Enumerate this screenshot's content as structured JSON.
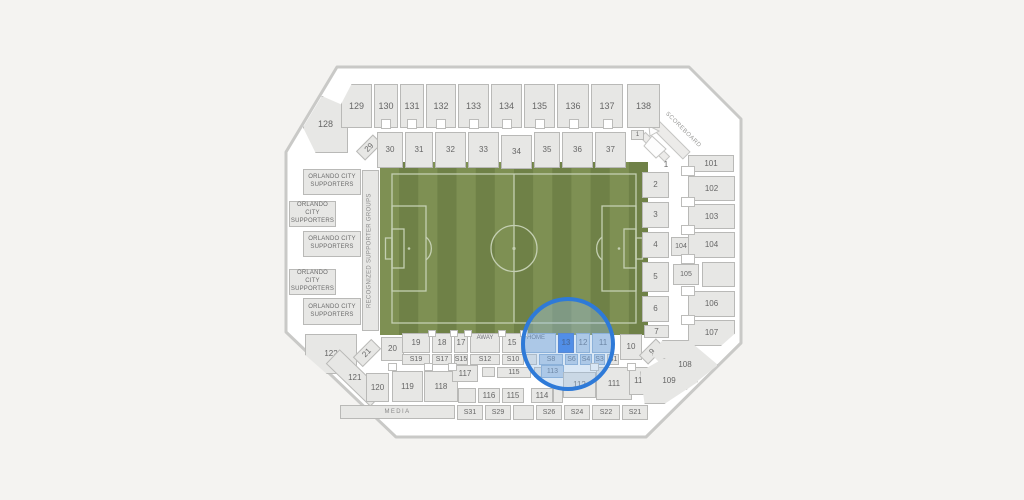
{
  "seatmap": {
    "selected_section": "13",
    "highlighted_sections": [
      "HOME",
      "13",
      "12",
      "11",
      "S8",
      "S6",
      "S4",
      "S3",
      "113"
    ],
    "colors": {
      "background": "#f4f3f1",
      "stadium_wall": "#c9c9c7",
      "section_fill": "#e7e7e5",
      "section_border": "#b9b9b7",
      "selected_fill": "#2470e8",
      "highlight_fill": "#b7cde9",
      "highlight_ring": "#2e7ad8",
      "field_green": "#7e9053",
      "field_stripe": "#6f8147",
      "field_lines": "#c4cfb2"
    },
    "sections": [
      {
        "id": "128",
        "label": "128"
      },
      {
        "id": "129",
        "label": "129"
      },
      {
        "id": "130",
        "label": "130"
      },
      {
        "id": "131",
        "label": "131"
      },
      {
        "id": "132",
        "label": "132"
      },
      {
        "id": "133",
        "label": "133"
      },
      {
        "id": "134",
        "label": "134"
      },
      {
        "id": "135",
        "label": "135"
      },
      {
        "id": "136",
        "label": "136"
      },
      {
        "id": "137",
        "label": "137"
      },
      {
        "id": "138",
        "label": "138"
      },
      {
        "id": "29",
        "label": "29"
      },
      {
        "id": "30",
        "label": "30"
      },
      {
        "id": "31",
        "label": "31"
      },
      {
        "id": "32",
        "label": "32"
      },
      {
        "id": "33",
        "label": "33"
      },
      {
        "id": "34",
        "label": "34"
      },
      {
        "id": "35",
        "label": "35"
      },
      {
        "id": "36",
        "label": "36"
      },
      {
        "id": "37",
        "label": "37"
      },
      {
        "id": "gate1",
        "label": "1"
      },
      {
        "id": "1",
        "label": "1"
      },
      {
        "id": "sup1",
        "label": "ORLANDO CITY SUPPORTERS"
      },
      {
        "id": "sup2",
        "label": "ORLANDO CITY SUPPORTERS"
      },
      {
        "id": "sup3",
        "label": "ORLANDO CITY SUPPORTERS"
      },
      {
        "id": "sup4",
        "label": "ORLANDO CITY SUPPORTERS"
      },
      {
        "id": "sup5",
        "label": "ORLANDO CITY SUPPORTERS"
      },
      {
        "id": "rsg",
        "label": "RECOGNIZED SUPPORTER GROUPS"
      },
      {
        "id": "2",
        "label": "2"
      },
      {
        "id": "3",
        "label": "3"
      },
      {
        "id": "4",
        "label": "4"
      },
      {
        "id": "5",
        "label": "5"
      },
      {
        "id": "6",
        "label": "6"
      },
      {
        "id": "7",
        "label": "7"
      },
      {
        "id": "104i",
        "label": "104"
      },
      {
        "id": "105i",
        "label": "105"
      },
      {
        "id": "101",
        "label": "101"
      },
      {
        "id": "102",
        "label": "102"
      },
      {
        "id": "103",
        "label": "103"
      },
      {
        "id": "104",
        "label": "104"
      },
      {
        "id": "105o",
        "label": ""
      },
      {
        "id": "106",
        "label": "106"
      },
      {
        "id": "107",
        "label": "107"
      },
      {
        "id": "scoreboard",
        "label": "SCOREBOARD"
      },
      {
        "id": "122",
        "label": "122"
      },
      {
        "id": "21",
        "label": "21"
      },
      {
        "id": "20",
        "label": "20"
      },
      {
        "id": "19",
        "label": "19"
      },
      {
        "id": "18",
        "label": "18"
      },
      {
        "id": "17",
        "label": "17"
      },
      {
        "id": "away",
        "label": "AWAY"
      },
      {
        "id": "15",
        "label": "15"
      },
      {
        "id": "home",
        "label": "HOME",
        "state": "tint"
      },
      {
        "id": "13",
        "label": "13",
        "state": "selected"
      },
      {
        "id": "12",
        "label": "12",
        "state": "tint"
      },
      {
        "id": "11",
        "label": "11",
        "state": "tint"
      },
      {
        "id": "10",
        "label": "10"
      },
      {
        "id": "9",
        "label": "9"
      },
      {
        "id": "s19",
        "label": "S19"
      },
      {
        "id": "s17",
        "label": "S17"
      },
      {
        "id": "s15",
        "label": "S15"
      },
      {
        "id": "s12",
        "label": "S12"
      },
      {
        "id": "s10",
        "label": "S10"
      },
      {
        "id": "bs",
        "label": ""
      },
      {
        "id": "s8",
        "label": "S8",
        "state": "tint"
      },
      {
        "id": "s6",
        "label": "S6",
        "state": "tint"
      },
      {
        "id": "s4",
        "label": "S4",
        "state": "tint"
      },
      {
        "id": "s3",
        "label": "S3",
        "state": "tint"
      },
      {
        "id": "s1",
        "label": "S1"
      },
      {
        "id": "121",
        "label": "121"
      },
      {
        "id": "120",
        "label": "120"
      },
      {
        "id": "119",
        "label": "119"
      },
      {
        "id": "118",
        "label": "118"
      },
      {
        "id": "117",
        "label": "117"
      },
      {
        "id": "b1",
        "label": ""
      },
      {
        "id": "115u",
        "label": "115"
      },
      {
        "id": "b2",
        "label": ""
      },
      {
        "id": "113",
        "label": "113",
        "state": "tint"
      },
      {
        "id": "112",
        "label": "112"
      },
      {
        "id": "111",
        "label": "111"
      },
      {
        "id": "110",
        "label": "110"
      },
      {
        "id": "108",
        "label": "108"
      },
      {
        "id": "109",
        "label": "109"
      },
      {
        "id": "c0",
        "label": ""
      },
      {
        "id": "116",
        "label": "116"
      },
      {
        "id": "115b",
        "label": "115"
      },
      {
        "id": "114",
        "label": "114"
      },
      {
        "id": "c2",
        "label": ""
      },
      {
        "id": "media",
        "label": "MEDIA"
      },
      {
        "id": "s31",
        "label": "S31"
      },
      {
        "id": "s29",
        "label": "S29"
      },
      {
        "id": "bb",
        "label": ""
      },
      {
        "id": "s26",
        "label": "S26"
      },
      {
        "id": "s24",
        "label": "S24"
      },
      {
        "id": "s22",
        "label": "S22"
      },
      {
        "id": "s21",
        "label": "S21"
      }
    ]
  }
}
